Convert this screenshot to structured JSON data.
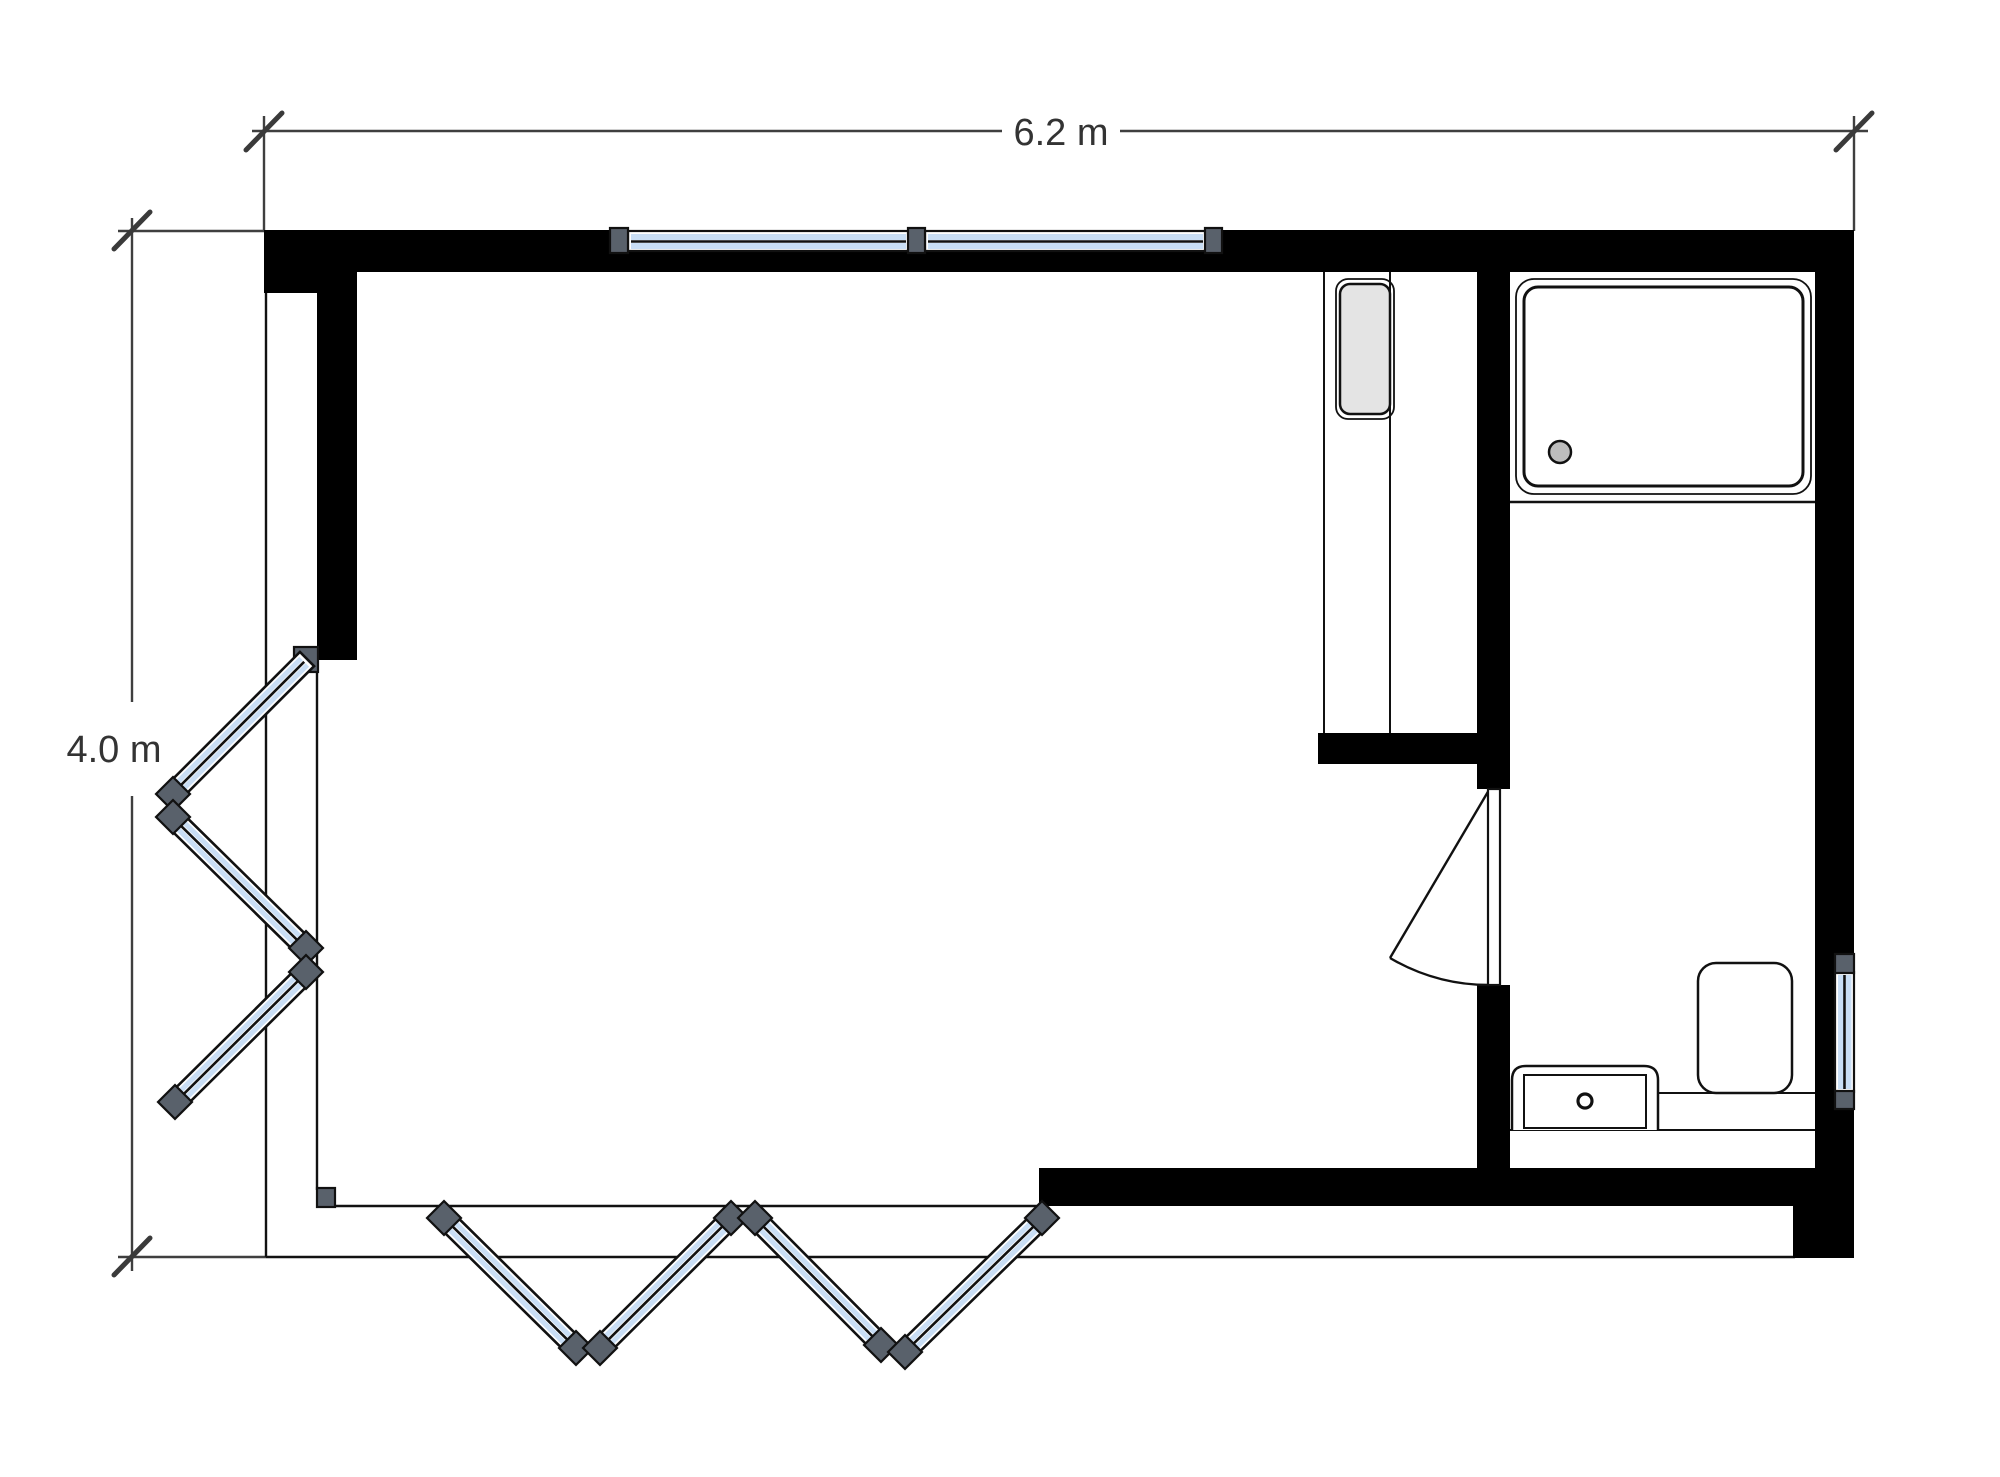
{
  "page": {
    "background": "#ffffff",
    "type": "architectural floor plan, top view"
  },
  "dimensions": {
    "width_label": "6.2 m",
    "height_label": "4.0 m"
  },
  "plan": {
    "rooms": [
      {
        "name": "main-room",
        "features": [
          "two windows on top wall",
          "tall cabinet unit",
          "corner bi-fold glazed doors"
        ]
      },
      {
        "name": "bathroom",
        "features": [
          "shower tray with drain",
          "toilet",
          "vanity sink with faucet",
          "window on right wall",
          "hinged door with swing arc"
        ]
      }
    ],
    "windows": {
      "top_wall_count": 2,
      "right_wall_count": 1
    },
    "folding_doors": {
      "left_panels": 3,
      "bottom_panels": 4
    },
    "colors": {
      "wall_black": "#000000",
      "glazing_blue": "#c9def5",
      "hinge_post_gray": "#59616b",
      "appliance_gray": "#e4e4e4",
      "drain_gray": "#bdbdbd",
      "dimension_gray": "#3a3a3a"
    }
  }
}
